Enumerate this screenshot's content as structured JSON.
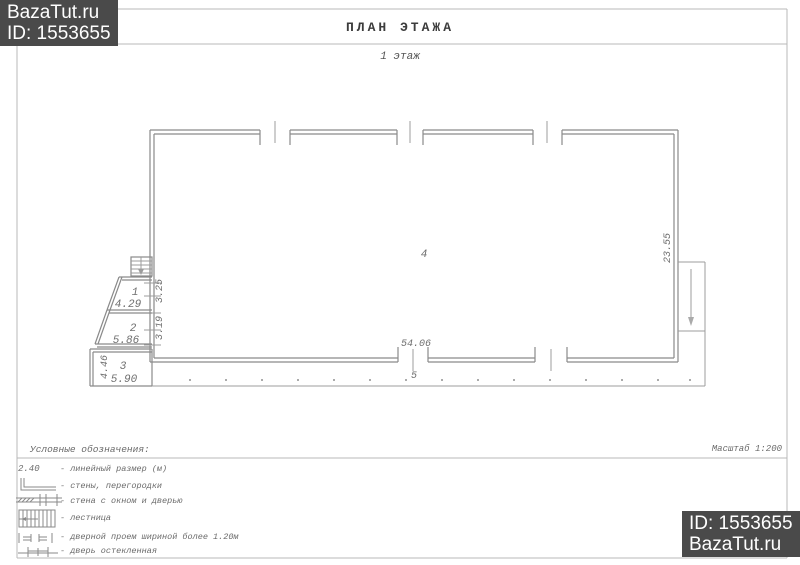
{
  "watermark_top": {
    "site": "BazaTut.ru",
    "id": "ID: 1553655"
  },
  "watermark_bottom": {
    "id": "ID: 1553655",
    "site": "BazaTut.ru"
  },
  "title": "ПЛАН ЭТАЖА",
  "floor_label": "1 этаж",
  "scale_label": "Масштаб 1:200",
  "plan": {
    "room1": {
      "number": "1",
      "width": "4.29",
      "depth": "3.25"
    },
    "room2": {
      "number": "2",
      "width": "5.86",
      "depth": "3.19"
    },
    "room3": {
      "number": "3",
      "width": "5.90",
      "depth": "4.46"
    },
    "hall": {
      "number": "4"
    },
    "porch": {
      "number": "5"
    },
    "total_width": "54.06",
    "total_depth": "23.55"
  },
  "legend": {
    "heading": "Условные обозначения:",
    "items": [
      {
        "symbol": "linear-dimension",
        "sample": "2.40",
        "label": "- линейный размер (м)"
      },
      {
        "symbol": "walls-partitions",
        "label": "- стены, перегородки"
      },
      {
        "symbol": "wall-window-door",
        "label": "- стена с окном и дверью"
      },
      {
        "symbol": "stairs",
        "label": "- лестница"
      },
      {
        "symbol": "door-opening-wide",
        "label": "- дверной проем шириной более 1.20м"
      },
      {
        "symbol": "glazed-door",
        "label": "- дверь остекленная"
      }
    ]
  },
  "colors": {
    "watermark_bg": "#4a4a4a",
    "watermark_text": "#ffffff",
    "drawing_line": "#8a8a8a",
    "frame_line": "#b9b9b9"
  }
}
